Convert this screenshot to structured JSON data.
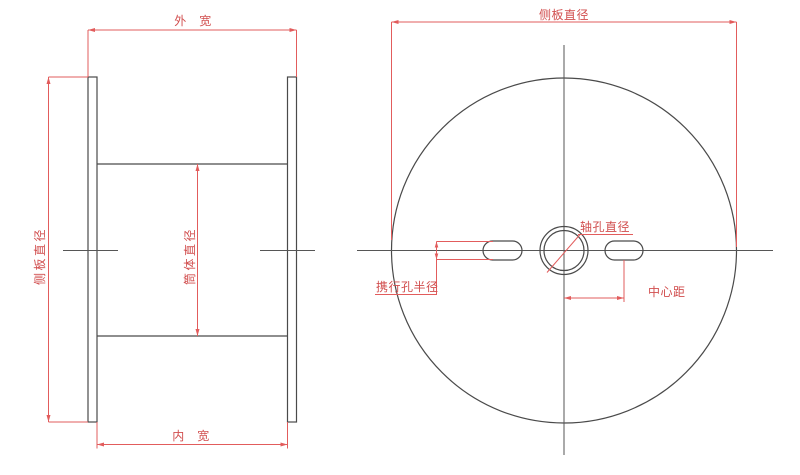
{
  "drawing": {
    "title": "spool-dimension-drawing",
    "colors": {
      "geometry_line": "#4A4A4A",
      "centerline": "#565656",
      "dimension_line": "#E25C5C",
      "dimension_text": "#D14E4E",
      "background": "#FFFFFF"
    },
    "side_view": {
      "labels": {
        "outer_width": "外　宽",
        "inner_width": "内　宽",
        "side_plate_diameter": "侧板直径",
        "barrel_diameter": "筒体直径"
      }
    },
    "front_view": {
      "labels": {
        "side_plate_diameter": "侧板直径",
        "axle_hole_diameter": "轴孔直径",
        "carry_hole_radius": "携行孔半径",
        "center_distance": "中心距"
      }
    }
  }
}
